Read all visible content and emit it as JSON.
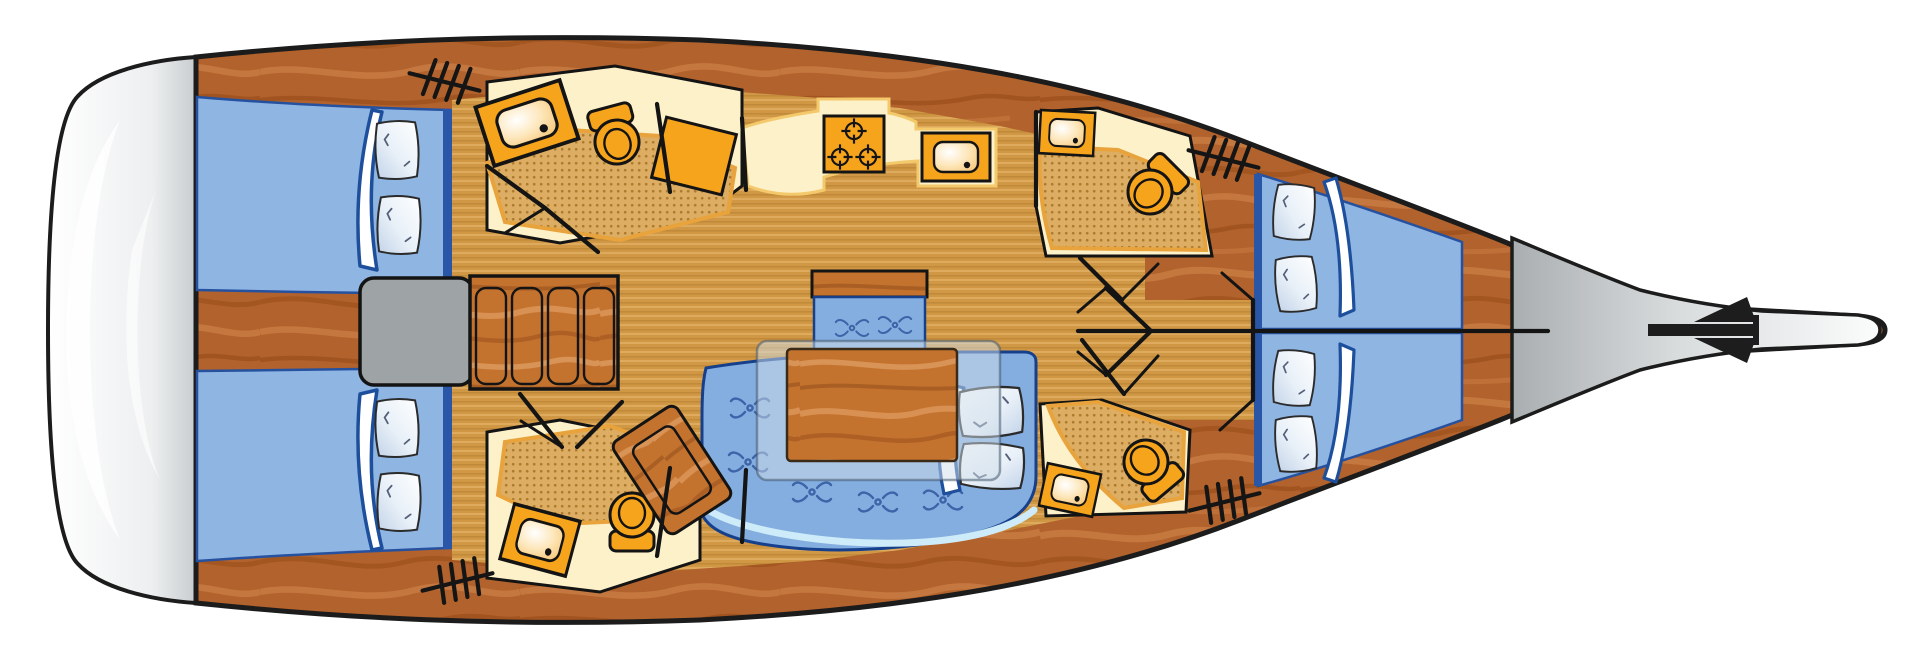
{
  "document": {
    "title": "Sailing yacht interior deck plan",
    "description": "Top-down floor plan of a sailing yacht, bow pointing right",
    "orientation": "bow-right"
  },
  "colors": {
    "hull_outline": "#1c1c1c",
    "wood_base": "#B2622C",
    "furniture_wood": "#C4732F",
    "floor_base": "#D09845",
    "counter_cream": "#FCF1C9",
    "counter_glow": "#F3C96B",
    "fixture_orange": "#F7A41D",
    "shower_base": "#DCAD62",
    "shower_dot": "#A87628",
    "bed_blue": "#8FB5E3",
    "bed_edge": "#2A56A8",
    "sofa_blue": "#84AEDF",
    "sofa_outline": "#16408c",
    "sofa_motif": "#3D63A8",
    "sofa_trim": "#CDEBF8",
    "pillow_white": "#FFFFFF",
    "engine_gray": "#9EA4A6",
    "glass": "rgba(208,222,233,0.5)",
    "anchor_black": "#1d1d1d"
  },
  "vessel": {
    "stern": {
      "name": "Stern / swim platform"
    },
    "aft_cabins": [
      {
        "name": "Aft double cabin (top)",
        "berth": "double",
        "pillows": 2
      },
      {
        "name": "Aft double cabin (bottom)",
        "berth": "double",
        "pillows": 2
      }
    ],
    "heads": [
      {
        "name": "Aft head (top)",
        "fixtures": [
          "washbasin",
          "toilet",
          "shower floor",
          "locker"
        ]
      },
      {
        "name": "Aft head (bottom)",
        "fixtures": [
          "washbasin",
          "toilet",
          "shower floor"
        ]
      },
      {
        "name": "Forward head (top)",
        "fixtures": [
          "washbasin",
          "toilet",
          "shower floor"
        ]
      },
      {
        "name": "Forward head (bottom)",
        "fixtures": [
          "washbasin",
          "toilet",
          "shower floor"
        ]
      }
    ],
    "galley": {
      "name": "Galley",
      "fixtures": [
        "three-burner stove",
        "sink"
      ],
      "burners": 3
    },
    "salon": {
      "name": "Salon",
      "furniture": [
        "U-shaped settee",
        "dining table",
        "acrylic table top",
        "bench seat",
        "angled seat cabinet"
      ],
      "pillows": 2
    },
    "engine": {
      "name": "Engine compartment"
    },
    "companionway": {
      "name": "Companionway steps",
      "slats": 4,
      "ladder_icons": 4
    },
    "forward_cabins": [
      {
        "name": "Forward V-berth cabin (top)",
        "pillows": 2
      },
      {
        "name": "Forward V-berth cabin (bottom)",
        "pillows": 2
      }
    ],
    "foredeck": {
      "name": "Foredeck"
    },
    "bow": {
      "name": "Bow with anchor fitting",
      "icon": "anchor-icon"
    }
  }
}
